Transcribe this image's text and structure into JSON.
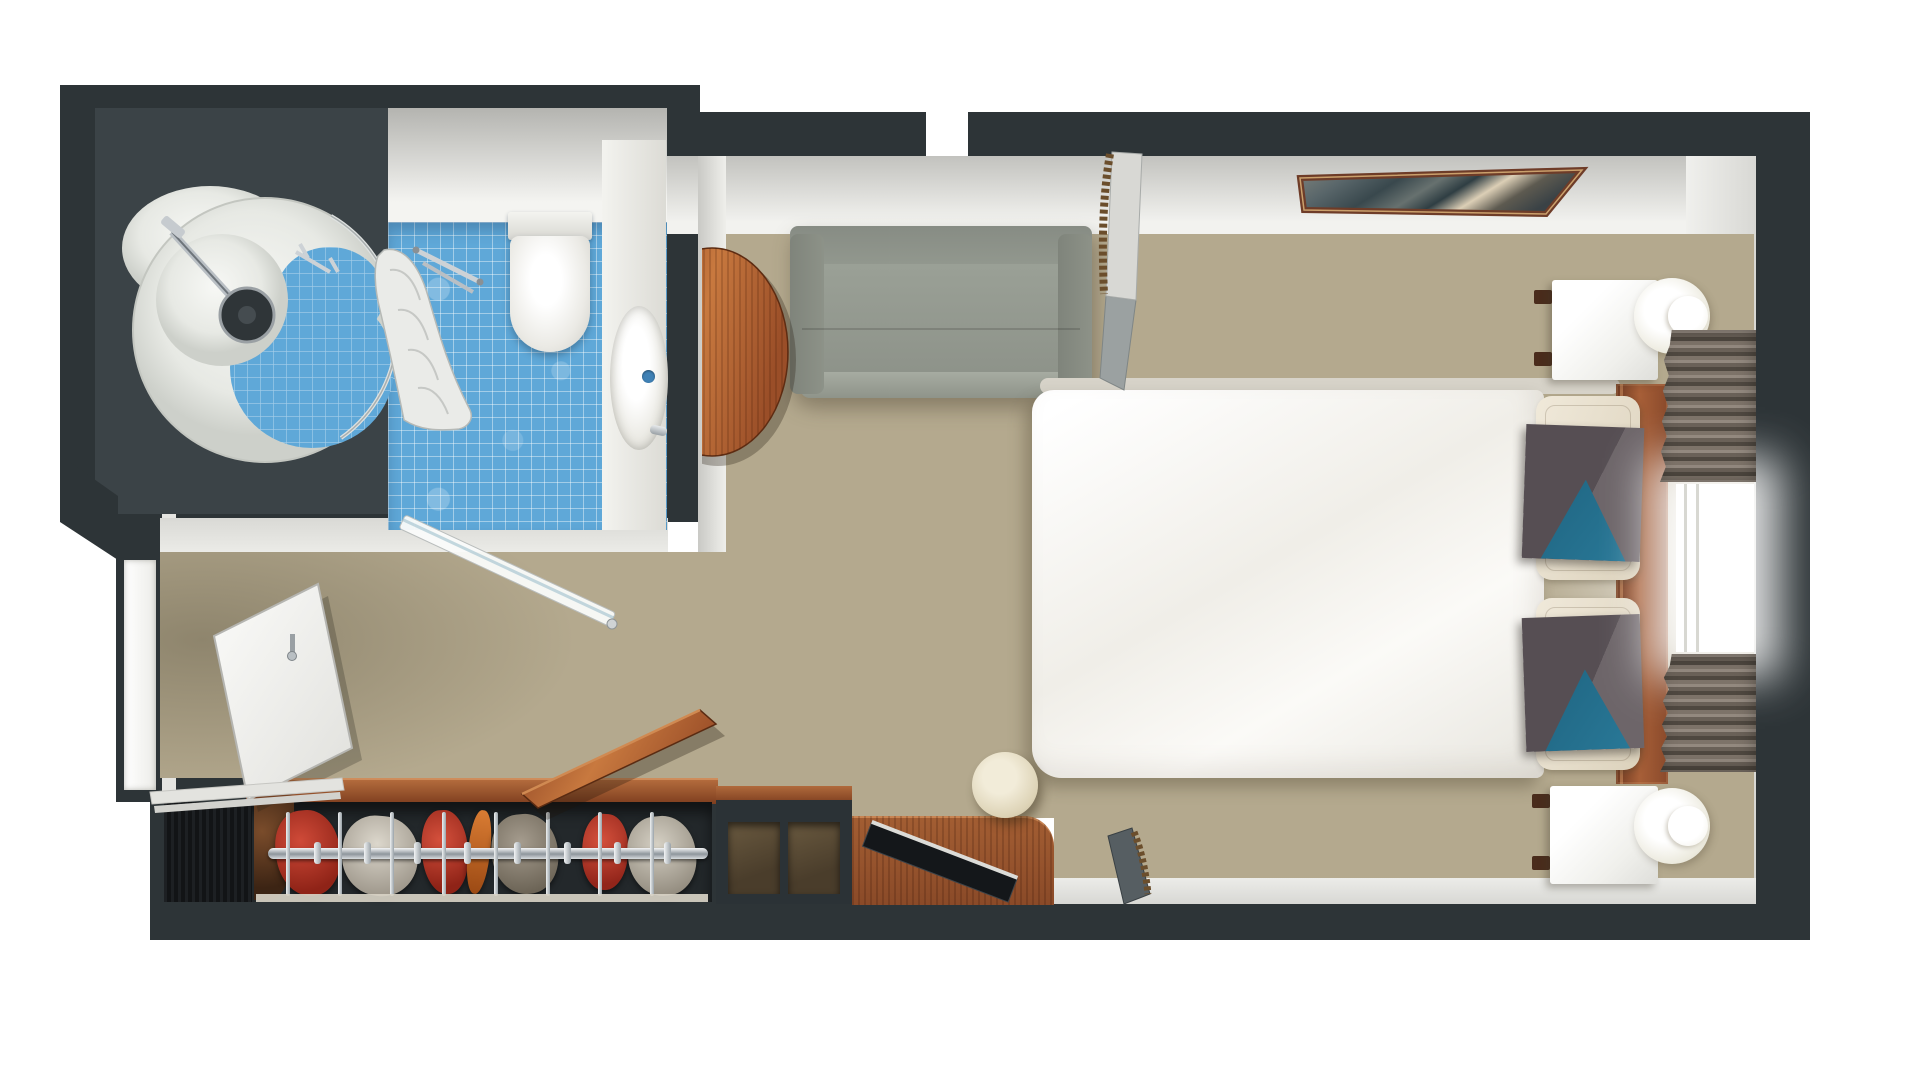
{
  "meta": {
    "view": "top-down 3D rendered floor plan",
    "scene": "Cabin / hotel room with en-suite bathroom, double bed, sofa, closet and desk"
  },
  "palette": {
    "wall": "#2d3437",
    "wall-inner": "#3b4347",
    "tile": "#5fa8d8",
    "carpet-dark": "#5e5138",
    "carpet-mid": "#8d7c5c",
    "carpet-light": "#a79877",
    "wood-dark": "#7e3e1f",
    "wood-mid": "#a35e33",
    "wood-light": "#c8793f",
    "sofa-gray": "#959a90",
    "duvet-white": "#f6f5f0",
    "pillow-cream": "#e9e1d0",
    "pillow-gray": "#5a5257",
    "pillow-blue": "#20647f",
    "cloth-red": "#b63425",
    "chrome": "#c7ccd0",
    "stool-cream": "#e7dfc8"
  },
  "labels": {
    "plan": "Cabin floor plan, top-down 3D render",
    "bathroom": "Bathroom",
    "shower": "Round shower with blue mosaic floor",
    "showerhead": "Shower head",
    "showerCurtain": "Shower curtain",
    "towelBar": "Towel bar",
    "toilet": "Toilet",
    "sink": "Vanity counter with oval sink",
    "bathroomDoor": "Open glass bathroom door",
    "entryDoorway": "Entry doorway",
    "entryDoor": "Open entry door",
    "corridor": "Entry corridor",
    "carpet": "Mottled brown carpet",
    "sofa": "Gray sofa",
    "sideTable": "Round wooden side table",
    "picture": "Framed landscape picture",
    "bed": "Double bed with white duvet",
    "mattress": "Mattress edge",
    "pillowCream1": "Cream pillow",
    "pillowCream2": "Cream pillow",
    "pillowAccent1": "Gray accent pillow with blue triangle",
    "pillowAccent2": "Gray accent pillow with blue triangle",
    "headboard": "Wooden headboard",
    "nightstand1": "White nightstand",
    "nightstand2": "White nightstand",
    "lamp1": "Round wall lamp",
    "lamp2": "Round wall lamp",
    "curtainTop": "Pleated window curtain",
    "curtainBottom": "Pleated window curtain",
    "window": "Window",
    "closet": "Open closet with rail, hangers and clothes",
    "closetDoor": "Open wooden closet door",
    "cabinet": "Dark cabinet",
    "shelf": "Open shelf unit",
    "desk": "Wooden desk",
    "tv": "Flat panel on desk",
    "stool": "Round cream stool",
    "rackTop": "Leaning panel with fringe",
    "rackBottom": "Leaning panel with fringe"
  },
  "rooms": {
    "bathroom": {
      "name": "Bathroom",
      "items": [
        "shower",
        "toilet",
        "sink",
        "showerCurtain",
        "towelBar",
        "bathroomDoor"
      ]
    },
    "cabin": {
      "name": "Main cabin",
      "items": [
        "sofa",
        "sideTable",
        "picture",
        "bed",
        "nightstand1",
        "nightstand2",
        "lamp1",
        "lamp2",
        "curtainTop",
        "window",
        "curtainBottom",
        "closet",
        "closetDoor",
        "desk",
        "tv",
        "stool",
        "rackTop",
        "rackBottom",
        "entryDoor"
      ]
    }
  }
}
